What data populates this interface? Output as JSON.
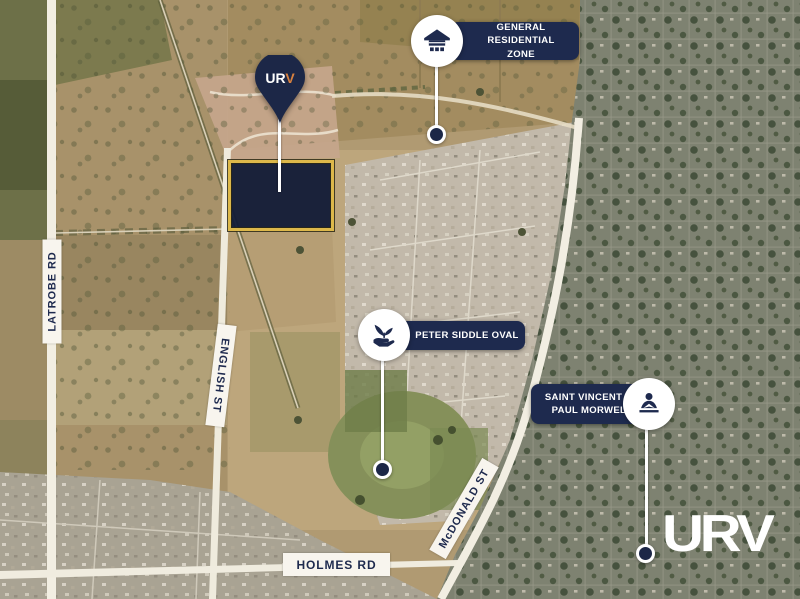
{
  "map": {
    "kind": "aerial-satellite-map"
  },
  "markers": {
    "grz": {
      "line1": "GENERAL RESIDENTIAL",
      "line2": "ZONE",
      "icon": "house"
    },
    "pso": {
      "line1": "PETER SIDDLE OVAL",
      "icon": "plant-in-hand"
    },
    "svp": {
      "line1": "SAINT VINCENT DE",
      "line2": "PAUL MORWELL",
      "icon": "person-reading"
    }
  },
  "pin": {
    "logo_left": "UR",
    "logo_right": "V"
  },
  "roads": {
    "latrobe": "LATROBE RD",
    "english": "ENGLISH ST",
    "mcdonald": "McDONALD ST",
    "holmes": "HOLMES RD"
  },
  "watermark": "URV",
  "colors": {
    "navy": "#1e2a4e",
    "gold": "#ddb84a",
    "white": "#ffffff",
    "orange_accent": "#d9813f"
  }
}
